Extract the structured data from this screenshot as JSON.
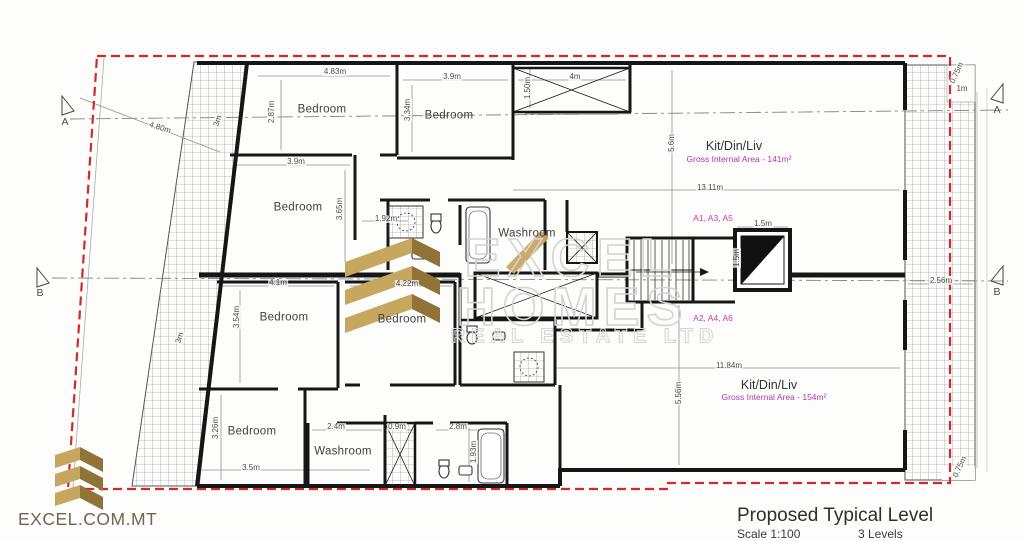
{
  "title_block": {
    "title": "Proposed Typical Level",
    "scale": "Scale 1:100",
    "levels": "3 Levels"
  },
  "branding": {
    "website": "EXCEL.COM.MT",
    "watermark1": "EXCEL",
    "watermark2": "HOMES",
    "watermark3": "REAL ESTATE LTD"
  },
  "plan": {
    "sections": {
      "a": "A",
      "b": "B"
    },
    "rooms": [
      "Bedroom",
      "Bedroom",
      "Bedroom",
      "Washroom",
      "Bedroom",
      "Bedroom",
      "Bedroom",
      "Washroom"
    ],
    "units": {
      "upper": {
        "name": "Kit/Din/Liv",
        "area": "Gross Internal Area - 141m²",
        "code": "A1, A3, A5"
      },
      "lower": {
        "name": "Kit/Din/Liv",
        "area": "Gross Internal Area - 154m²",
        "code": "A2, A4, A6"
      }
    },
    "dims": [
      "4.80m",
      "4.83m",
      "2.87m",
      "3.9m",
      "3.34m",
      "4m",
      "1.50m",
      "3m",
      "3.9m",
      "3.65m",
      "1.92m",
      "13.11m",
      "5.6m",
      "1.5m",
      "1.5m",
      "4.1m",
      "3.54m",
      "4.22m",
      "11.84m",
      "5.56m",
      "2.56m",
      "3.5m",
      "3.26m",
      "2.4m",
      "0.9m",
      "2.8m",
      "1.93m",
      "0.75m",
      "0.75m",
      "1m",
      "3m"
    ]
  },
  "colors": {
    "boundary_red": "#d02a2a",
    "unit_magenta": "#b136b1",
    "gold": "#c7a75f",
    "gold_dark": "#8f7338",
    "watermark_gray": "#d3d3d3"
  }
}
